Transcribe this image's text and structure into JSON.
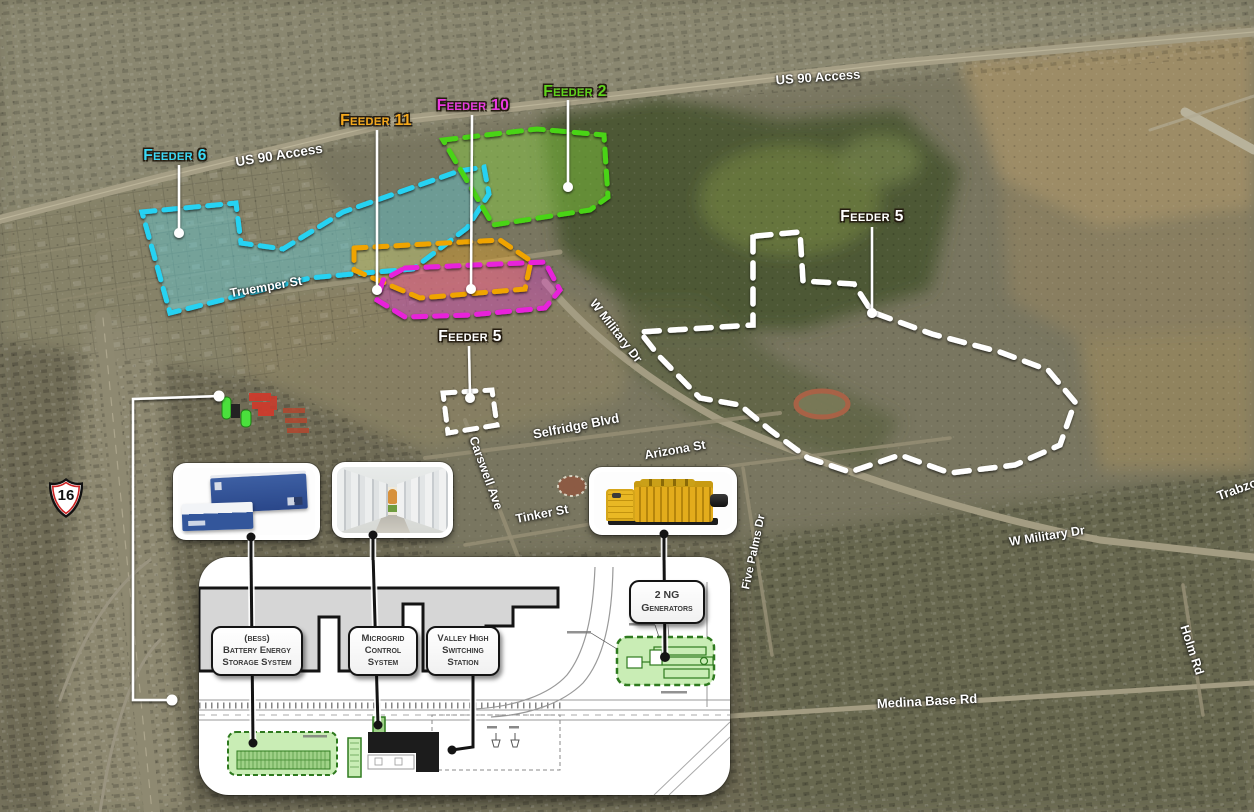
{
  "map": {
    "highway_shield": "16",
    "street_labels": {
      "us90_left": "US 90 Access",
      "us90_right": "US 90 Access",
      "truemper": "Truemper St",
      "w_military_center": "W Military Dr",
      "w_military_east": "W Military Dr",
      "selfridge": "Selfridge Blvd",
      "arizona": "Arizona St",
      "carswell": "Carswell Ave",
      "tinker": "Tinker St",
      "five_palms": "Five Palms Dr",
      "medina_base": "Medina Base Rd",
      "holm": "Holm Rd",
      "trabzon": "Trabzo"
    },
    "feeder_labels": {
      "feeder6": {
        "text": "Feeder 6",
        "color": "#3ad9f7"
      },
      "feeder11": {
        "text": "Feeder 11",
        "color": "#f5a81c"
      },
      "feeder10": {
        "text": "Feeder 10",
        "color": "#ea3ae2"
      },
      "feeder2": {
        "text": "Feeder 2",
        "color": "#5fd41d"
      },
      "feeder5_west": {
        "text": "Feeder 5",
        "color": "#ffffff"
      },
      "feeder5_east": {
        "text": "Feeder 5",
        "color": "#ffffff"
      }
    }
  },
  "inset": {
    "labels": {
      "bess": {
        "line1": "(BESS)",
        "line2": "Battery Energy",
        "line3": "Storage System"
      },
      "microgrid": {
        "line1": "Microgrid",
        "line2": "Control",
        "line3": "System"
      },
      "valley_high": {
        "line1": "Valley High",
        "line2": "Switching",
        "line3": "Station"
      },
      "generators": {
        "line1": "2 NG",
        "line2": "Generators"
      }
    }
  }
}
